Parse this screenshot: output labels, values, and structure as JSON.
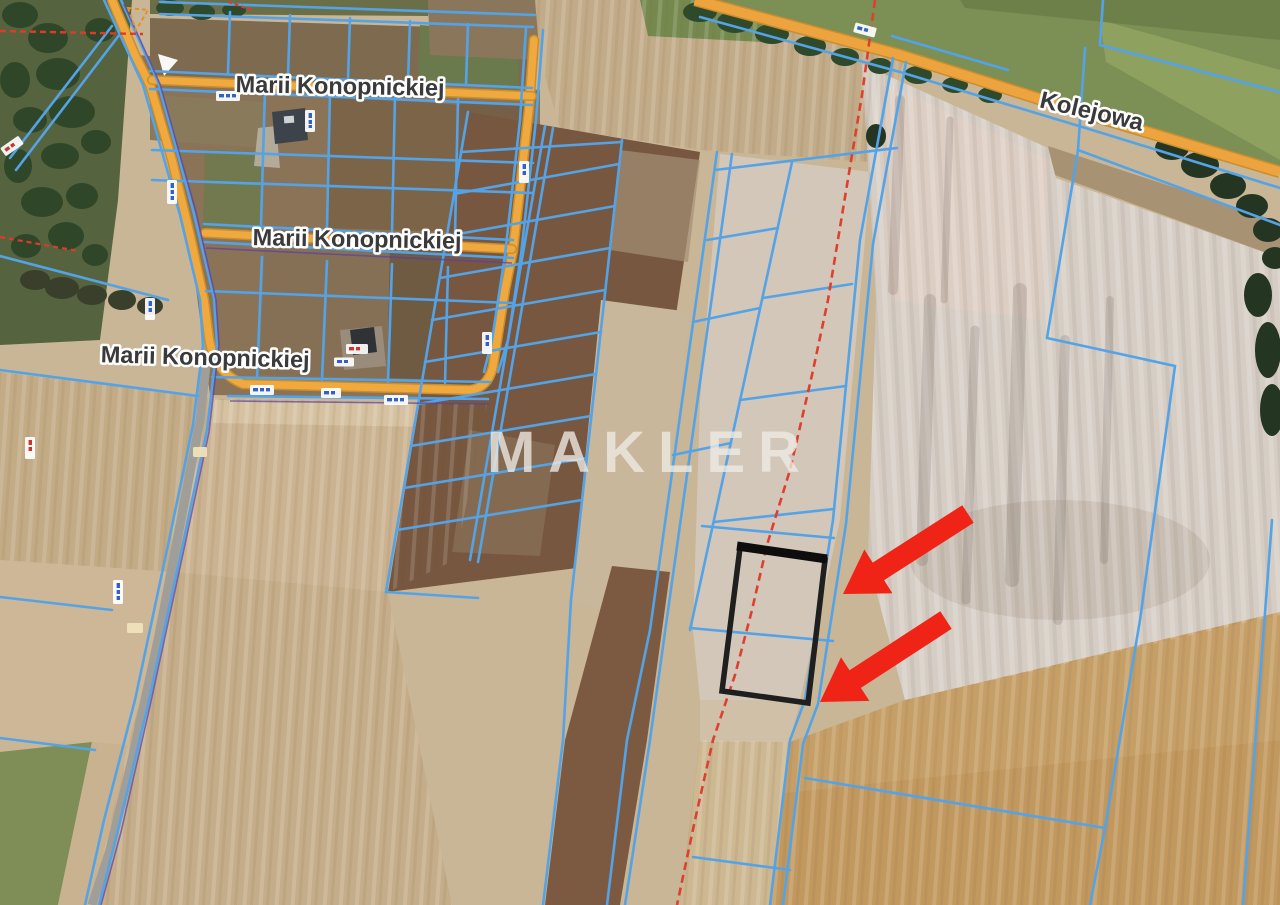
{
  "map": {
    "type": "satellite-cadastral-map",
    "watermark": {
      "text": "MAKLER"
    },
    "streets": [
      {
        "name": "Marii Konopnickiej"
      },
      {
        "name": "Marii Konopnickiej"
      },
      {
        "name": "Marii Konopnickiej"
      },
      {
        "name": "Kolejowa"
      }
    ],
    "annotations": {
      "highlighted_parcel": true,
      "arrow_count": 2,
      "arrow_color": "#ef2417",
      "highlighted_parcel_outline_color": "#1f1f1f",
      "dashed_boundary_color": "#dd4030"
    },
    "colors": {
      "parcel_line": "#54a3e6",
      "road_fill": "#eda43e",
      "road_casing": "#c98e2e",
      "main_road_fill": "#a09e98"
    }
  }
}
